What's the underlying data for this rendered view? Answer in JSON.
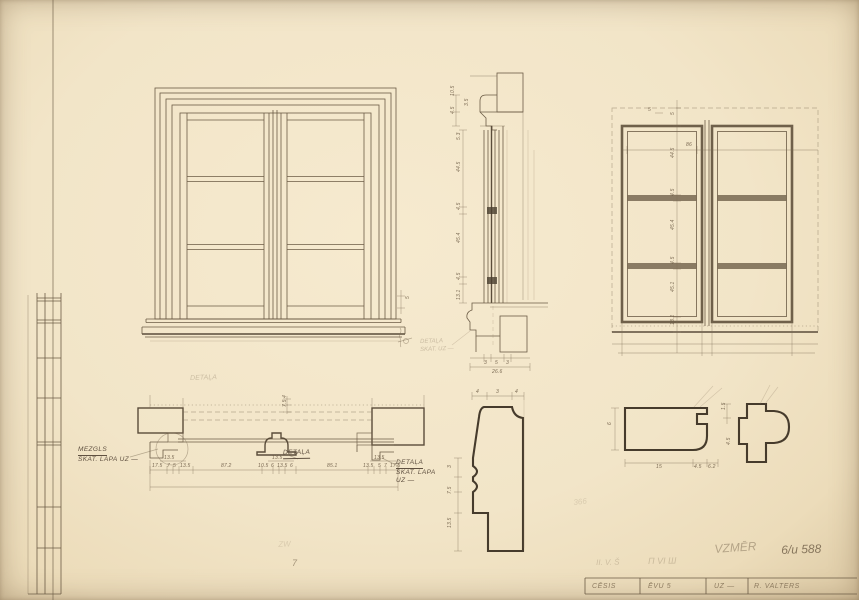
{
  "palette": {
    "paper": "#f2e5c8",
    "line": "#6b5b45",
    "bold": "#463b2c",
    "pencil": "#8d7c63"
  },
  "labels": {
    "mezgls_title": "MEZGLS",
    "mezgls_sub": "SKAT. LAPA UZ —",
    "detala_center": "DETAĻA",
    "detala_right_1": "DETAĻA",
    "detala_right_2": "SKAT. LAPA",
    "detala_right_3": "UZ —"
  },
  "title_block": {
    "cells": [
      "CĒSIS",
      "ĒVU 5",
      "UZ —",
      "R. VALTERS"
    ]
  },
  "pencil_notes": [
    {
      "t": "DETAĻA",
      "x": 190,
      "y": 375,
      "s": 7,
      "o": 0.3,
      "r": -2
    },
    {
      "t": "DETAĻA",
      "x": 420,
      "y": 339,
      "s": 6,
      "o": 0.32,
      "r": -2
    },
    {
      "t": "SKAT. UZ —",
      "x": 420,
      "y": 347,
      "s": 6,
      "o": 0.32,
      "r": -2
    },
    {
      "t": "VZMĒR",
      "x": 714,
      "y": 542,
      "s": 12,
      "o": 0.45,
      "r": -4
    },
    {
      "t": "6/u 588",
      "x": 781,
      "y": 543,
      "s": 12,
      "o": 0.8,
      "r": -2
    },
    {
      "t": "П VI Ш",
      "x": 648,
      "y": 556,
      "s": 9,
      "o": 0.28,
      "r": -1
    },
    {
      "t": "II. V. Š",
      "x": 596,
      "y": 558,
      "s": 8,
      "o": 0.26,
      "r": -1
    },
    {
      "t": "7",
      "x": 292,
      "y": 558,
      "s": 9,
      "o": 0.6,
      "r": 0
    },
    {
      "t": "366",
      "x": 573,
      "y": 498,
      "s": 8,
      "o": 0.18,
      "r": -6
    },
    {
      "t": "ZW",
      "x": 278,
      "y": 540,
      "s": 8,
      "o": 0.18,
      "r": -3
    }
  ],
  "dims": [
    {
      "t": "10.5",
      "x": 451,
      "y": 96,
      "r": -90
    },
    {
      "t": "4.5",
      "x": 451,
      "y": 114,
      "r": -90
    },
    {
      "t": "3.5",
      "x": 465,
      "y": 106,
      "r": -90
    },
    {
      "t": "5.3",
      "x": 457,
      "y": 140,
      "r": -90
    },
    {
      "t": "44.5",
      "x": 457,
      "y": 172,
      "r": -90
    },
    {
      "t": "4.5",
      "x": 457,
      "y": 210,
      "r": -90
    },
    {
      "t": "45.4",
      "x": 457,
      "y": 243,
      "r": -90
    },
    {
      "t": "4.5",
      "x": 457,
      "y": 280,
      "r": -90
    },
    {
      "t": "13.1",
      "x": 457,
      "y": 300,
      "r": -90
    },
    {
      "t": "3",
      "x": 484,
      "y": 361,
      "r": 0
    },
    {
      "t": "5",
      "x": 495,
      "y": 361,
      "r": 0
    },
    {
      "t": "3",
      "x": 506,
      "y": 361,
      "r": 0
    },
    {
      "t": "26.6",
      "x": 492,
      "y": 370,
      "r": 0
    },
    {
      "t": "5",
      "x": 648,
      "y": 108,
      "r": 0
    },
    {
      "t": "86",
      "x": 686,
      "y": 143,
      "r": 0
    },
    {
      "t": "5",
      "x": 671,
      "y": 115,
      "r": -90
    },
    {
      "t": "44.5",
      "x": 671,
      "y": 158,
      "r": -90
    },
    {
      "t": "4.5",
      "x": 671,
      "y": 196,
      "r": -90
    },
    {
      "t": "45.4",
      "x": 671,
      "y": 230,
      "r": -90
    },
    {
      "t": "4.5",
      "x": 671,
      "y": 264,
      "r": -90
    },
    {
      "t": "45.1",
      "x": 671,
      "y": 292,
      "r": -90
    },
    {
      "t": "13.1",
      "x": 671,
      "y": 325,
      "r": -90
    },
    {
      "t": "5",
      "x": 406,
      "y": 299,
      "r": -90
    },
    {
      "t": "4",
      "x": 283,
      "y": 398,
      "r": -90
    },
    {
      "t": "7.5",
      "x": 283,
      "y": 407,
      "r": -90
    },
    {
      "t": "17.5",
      "x": 152,
      "y": 464,
      "r": 0
    },
    {
      "t": "7",
      "x": 167,
      "y": 464,
      "r": 0
    },
    {
      "t": "5",
      "x": 173,
      "y": 464,
      "r": 0
    },
    {
      "t": "13.5",
      "x": 180,
      "y": 464,
      "r": 0
    },
    {
      "t": "13.5",
      "x": 164,
      "y": 456,
      "r": 0
    },
    {
      "t": "87.2",
      "x": 221,
      "y": 464,
      "r": 0
    },
    {
      "t": "10.5",
      "x": 258,
      "y": 464,
      "r": 0
    },
    {
      "t": "6",
      "x": 271,
      "y": 464,
      "r": 0
    },
    {
      "t": "13.5",
      "x": 277,
      "y": 464,
      "r": 0
    },
    {
      "t": "6",
      "x": 290,
      "y": 464,
      "r": 0
    },
    {
      "t": "13.5",
      "x": 272,
      "y": 456,
      "r": 0
    },
    {
      "t": "85.1",
      "x": 327,
      "y": 464,
      "r": 0
    },
    {
      "t": "13.5",
      "x": 363,
      "y": 464,
      "r": 0
    },
    {
      "t": "5",
      "x": 378,
      "y": 464,
      "r": 0
    },
    {
      "t": "7",
      "x": 384,
      "y": 464,
      "r": 0
    },
    {
      "t": "17.5",
      "x": 390,
      "y": 464,
      "r": 0
    },
    {
      "t": "13.5",
      "x": 374,
      "y": 456,
      "r": 0
    },
    {
      "t": "4",
      "x": 476,
      "y": 390,
      "r": 0
    },
    {
      "t": "3",
      "x": 496,
      "y": 390,
      "r": 0
    },
    {
      "t": "4",
      "x": 515,
      "y": 390,
      "r": 0
    },
    {
      "t": "3",
      "x": 448,
      "y": 468,
      "r": -90
    },
    {
      "t": "7.5",
      "x": 448,
      "y": 494,
      "r": -90
    },
    {
      "t": "13.5",
      "x": 448,
      "y": 528,
      "r": -90
    },
    {
      "t": "6",
      "x": 608,
      "y": 425,
      "r": -90
    },
    {
      "t": "15",
      "x": 656,
      "y": 465,
      "r": 0
    },
    {
      "t": "4.5",
      "x": 694,
      "y": 465,
      "r": 0
    },
    {
      "t": "6.2",
      "x": 708,
      "y": 465,
      "r": 0
    },
    {
      "t": "1.5",
      "x": 722,
      "y": 410,
      "r": -90
    },
    {
      "t": "4.5",
      "x": 727,
      "y": 445,
      "r": -90
    }
  ]
}
